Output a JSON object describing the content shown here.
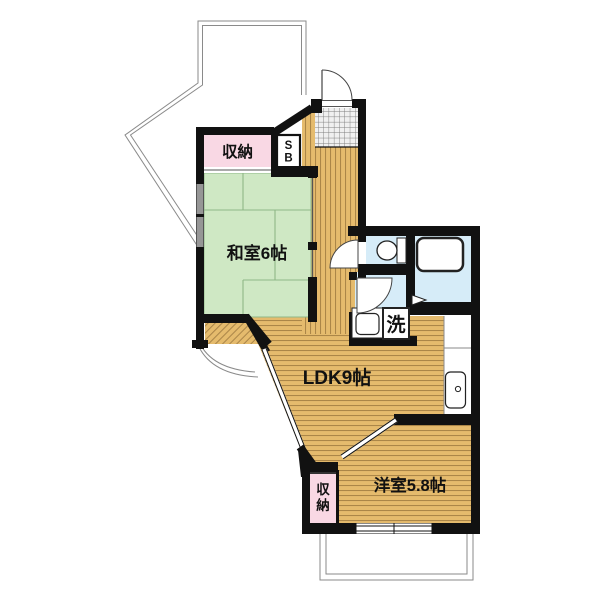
{
  "plan": {
    "title": "1LDK+和室 間取り図",
    "labels": {
      "closet_top": "収納",
      "shoebox_line1": "S",
      "shoebox_line2": "B",
      "washitsu": "和室6帖",
      "ldk": "LDK9帖",
      "yoshitsu": "洋室5.8帖",
      "laundry": "洗",
      "closet_bottom_line1": "収",
      "closet_bottom_line2": "納"
    },
    "colors": {
      "tatami": "#cfe8c4",
      "tatami_line": "#8fb787",
      "wood": "#e5bb6d",
      "wood_line": "#8a6733",
      "closet_pink": "#f9d8e4",
      "wet_blue": "#d6ecf8",
      "wall": "#111111",
      "outline_gray": "#8a8a8a",
      "fixture_stroke": "#222222",
      "grid_bg": "#f0f0f0",
      "grid_line": "#7d7d7d"
    }
  }
}
